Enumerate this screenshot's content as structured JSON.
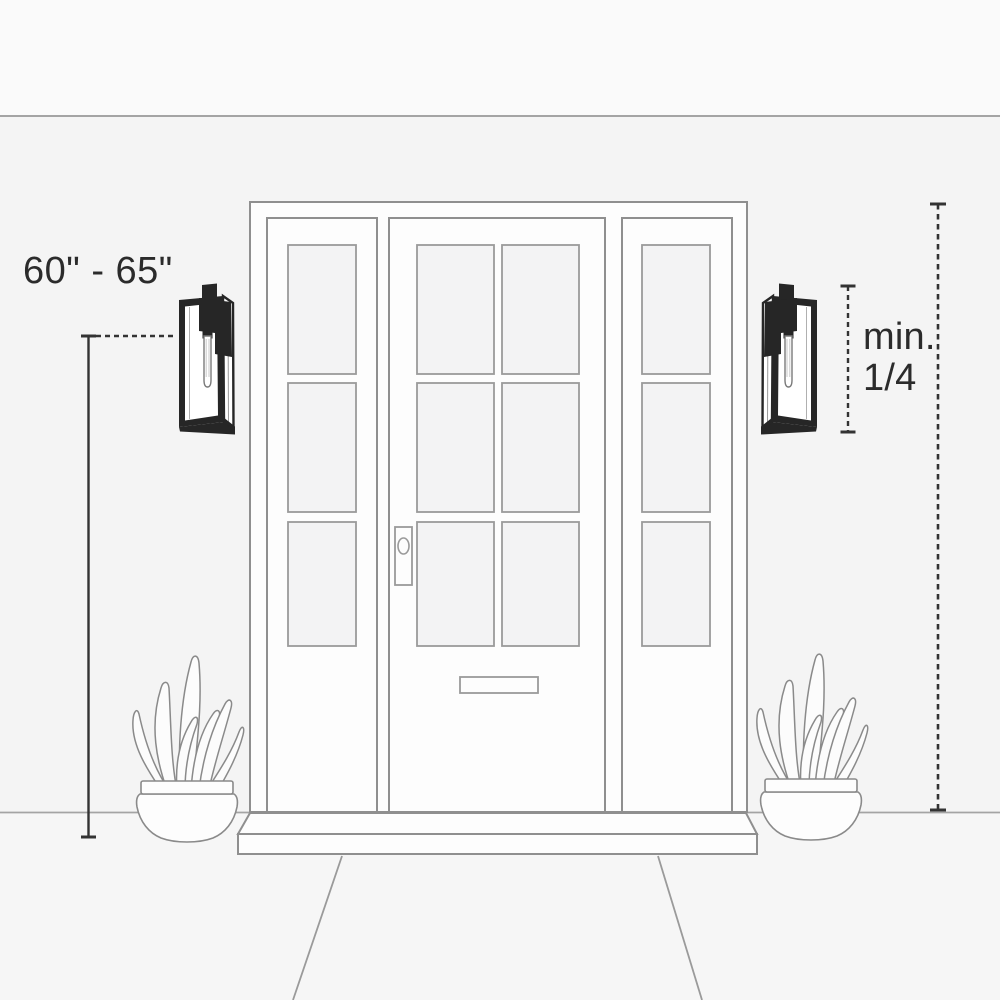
{
  "diagram": {
    "type": "installation-guide",
    "subject": "Outdoor wall lantern mounting height beside a front entry door"
  },
  "annotations": {
    "mounting_height_label": "60\" - 65\"",
    "min_ratio_line1": "min.",
    "min_ratio_line2": "1/4"
  },
  "scene": {
    "elements": [
      "front-door-with-six-panes",
      "left-sidelight-with-three-panes",
      "right-sidelight-with-three-panes",
      "left-wall-sconce",
      "right-wall-sconce",
      "left-potted-snake-plant",
      "right-potted-snake-plant",
      "porch-step",
      "walkway",
      "door-lock",
      "mail-slot"
    ],
    "dimensions": [
      {
        "name": "mounting-height",
        "label": "60\" - 65\"",
        "style": "solid vertical line with end caps and dashed extension to fixture"
      },
      {
        "name": "fixture-height",
        "label": "min. 1/4",
        "style": "dashed vertical line with end caps spanning the sconce"
      },
      {
        "name": "door-height-reference",
        "style": "dashed vertical line with end caps spanning frame top to ground"
      }
    ]
  },
  "colors": {
    "wall": "#f4f4f4",
    "sky_band": "#fafafa",
    "foreground": "#f6f6f6",
    "structure_fill": "#fdfdfd",
    "pane_fill": "#f3f3f4",
    "outline": "#8f8f8f",
    "outline_light": "#a4a4a4",
    "fixture_dark": "#262626",
    "dimension": "#333333",
    "text": "#2b2b2b"
  }
}
